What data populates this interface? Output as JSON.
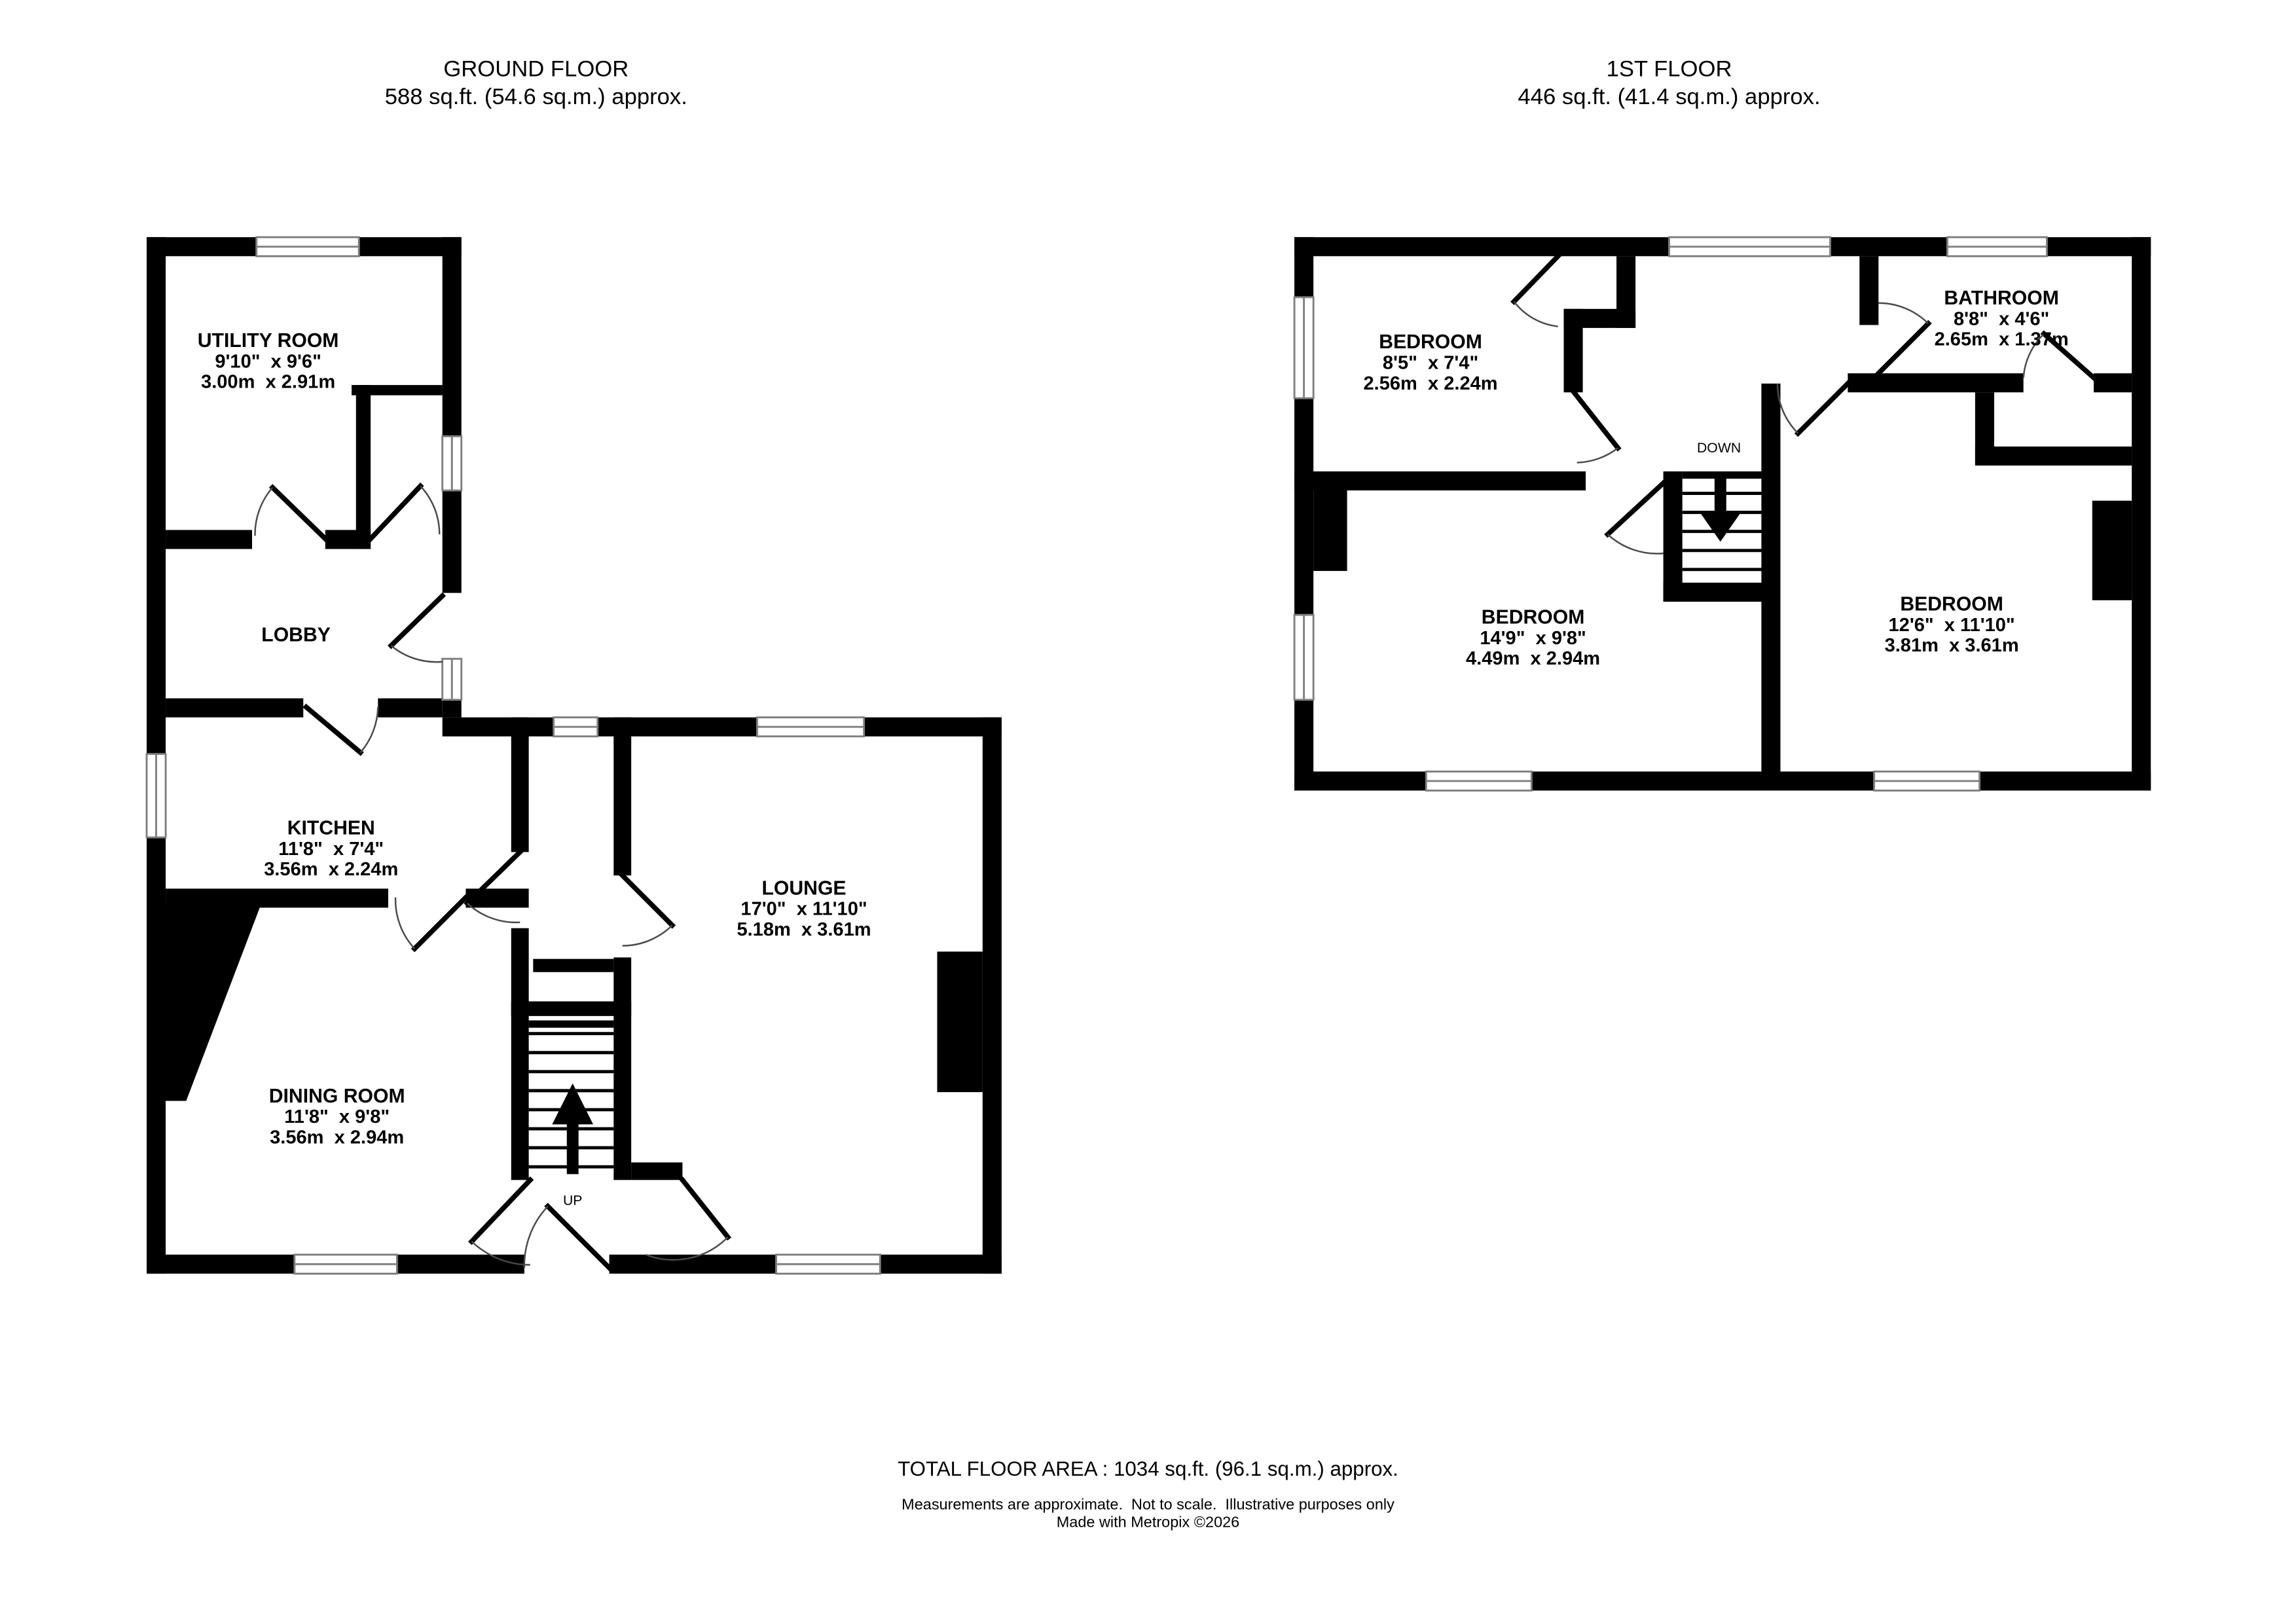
{
  "colors": {
    "wall": "#000000",
    "background": "#ffffff"
  },
  "ground_floor": {
    "title": "GROUND FLOOR",
    "area_line": "588 sq.ft. (54.6 sq.m.) approx.",
    "stair_direction_label": "UP",
    "rooms": [
      {
        "name": "UTILITY ROOM",
        "imperial": "9'10\"  x 9'6\"",
        "metric": "3.00m  x 2.91m"
      },
      {
        "name": "LOBBY",
        "imperial": "",
        "metric": ""
      },
      {
        "name": "KITCHEN",
        "imperial": "11'8\"  x 7'4\"",
        "metric": "3.56m  x 2.24m"
      },
      {
        "name": "LOUNGE",
        "imperial": "17'0\"  x 11'10\"",
        "metric": "5.18m  x 3.61m"
      },
      {
        "name": "DINING ROOM",
        "imperial": "11'8\"  x 9'8\"",
        "metric": "3.56m  x 2.94m"
      }
    ]
  },
  "first_floor": {
    "title": "1ST FLOOR",
    "area_line": "446 sq.ft. (41.4 sq.m.) approx.",
    "stair_direction_label": "DOWN",
    "rooms": [
      {
        "name": "BEDROOM",
        "imperial": "8'5\"  x 7'4\"",
        "metric": "2.56m  x 2.24m"
      },
      {
        "name": "BATHROOM",
        "imperial": "8'8\"  x 4'6\"",
        "metric": "2.65m  x 1.37m"
      },
      {
        "name": "BEDROOM",
        "imperial": "14'9\"  x 9'8\"",
        "metric": "4.49m  x 2.94m"
      },
      {
        "name": "BEDROOM",
        "imperial": "12'6\"  x 11'10\"",
        "metric": "3.81m  x 3.61m"
      }
    ]
  },
  "footer": {
    "total_area": "TOTAL FLOOR AREA : 1034 sq.ft. (96.1 sq.m.) approx.",
    "disclaimer": "Measurements are approximate.  Not to scale.  Illustrative purposes only",
    "credit": "Made with Metropix ©2026"
  }
}
